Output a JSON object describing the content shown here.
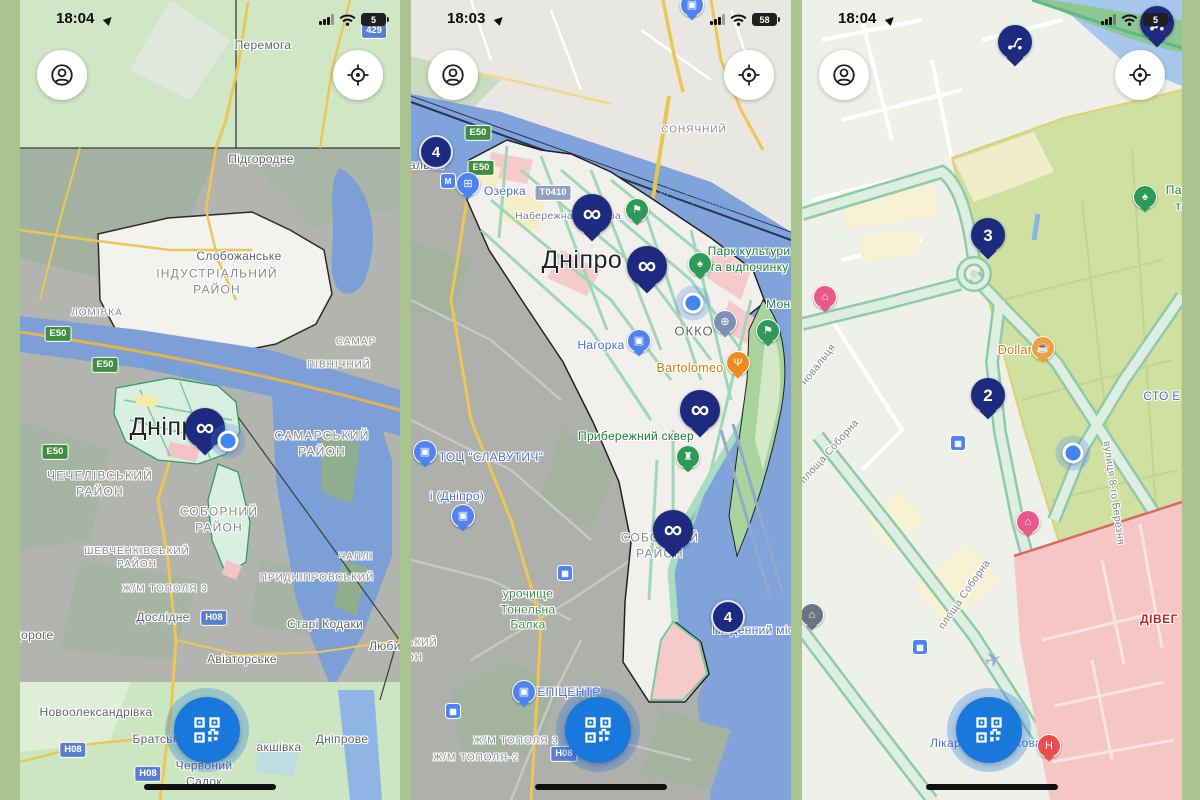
{
  "app": {
    "background_color": "#a9c48f",
    "colors": {
      "marker_navy": "#1c2b80",
      "qr_button_blue": "#1878dc",
      "location_dot_blue": "#4285f4",
      "road_badge_green": "#3f8f3f",
      "road_badge_blue": "#5b7fd0",
      "poi_blue": "#4f84f0",
      "poi_green": "#2d9b57"
    }
  },
  "phones": [
    {
      "status": {
        "time": "18:04",
        "battery": "5"
      },
      "labels": [
        {
          "t": "Перемога",
          "c": "town",
          "x": 243,
          "y": 46
        },
        {
          "t": "Підгородне",
          "c": "town",
          "x": 241,
          "y": 160
        },
        {
          "t": "Слобожанське",
          "c": "town",
          "x": 219,
          "y": 257
        },
        {
          "t": "ІНДУСТРІАЛЬНИЙ\nРАЙОН",
          "c": "district",
          "x": 197,
          "y": 282
        },
        {
          "t": "ЛОМІВКА",
          "c": "district-sm",
          "x": 77,
          "y": 313
        },
        {
          "t": "САМАР",
          "c": "district-sm",
          "x": 336,
          "y": 342
        },
        {
          "t": "ПІВНІЧНИЙ",
          "c": "district-sm",
          "x": 319,
          "y": 365
        },
        {
          "t": "Е50",
          "c": "badge-green",
          "x": 38,
          "y": 334
        },
        {
          "t": "Е50",
          "c": "badge-green",
          "x": 85,
          "y": 365
        },
        {
          "t": "Е50",
          "c": "badge-green",
          "x": 35,
          "y": 452
        },
        {
          "t": "річка Дніпро",
          "c": "water-label",
          "x": 163,
          "y": 373,
          "r": 16
        },
        {
          "t": "Дніпро",
          "c": "city",
          "x": 150,
          "y": 427
        },
        {
          "t": "САМАРСЬКИЙ\nРАЙОН",
          "c": "district",
          "x": 302,
          "y": 444
        },
        {
          "t": "ЧЕЧЕЛІВСЬКИЙ\nРАЙОН",
          "c": "district",
          "x": 80,
          "y": 484
        },
        {
          "t": "СОБОРНИЙ\nРАЙОН",
          "c": "district",
          "x": 199,
          "y": 520
        },
        {
          "t": "ШЕВЧЕНКІВСЬКИЙ\nРАЙОН",
          "c": "district-sm",
          "x": 117,
          "y": 558
        },
        {
          "t": "ЧАПЛІ",
          "c": "district-sm",
          "x": 336,
          "y": 557
        },
        {
          "t": "ПРИДНІПРОВСЬКИЙ",
          "c": "district-sm",
          "x": 297,
          "y": 578
        },
        {
          "t": "Ж/М ТОПОЛЯ 3",
          "c": "district-sm",
          "x": 145,
          "y": 589
        },
        {
          "t": "Дослідне",
          "c": "town",
          "x": 143,
          "y": 618
        },
        {
          "t": "Н08",
          "c": "badge-blue",
          "x": 194,
          "y": 618
        },
        {
          "t": "Старі Кодаки",
          "c": "town",
          "x": 305,
          "y": 625
        },
        {
          "t": "Дороге",
          "c": "town",
          "x": 13,
          "y": 636
        },
        {
          "t": "Авіаторське",
          "c": "town",
          "x": 222,
          "y": 660
        },
        {
          "t": "Любимів",
          "c": "town",
          "x": 374,
          "y": 647
        },
        {
          "t": "Новоолександрівка",
          "c": "town",
          "x": 76,
          "y": 713
        },
        {
          "t": "Н08",
          "c": "badge-blue",
          "x": 53,
          "y": 750
        },
        {
          "t": "Братське",
          "c": "town",
          "x": 139,
          "y": 740
        },
        {
          "t": "акшівка",
          "c": "town",
          "x": 259,
          "y": 748
        },
        {
          "t": "Дніпрове",
          "c": "town",
          "x": 322,
          "y": 740
        },
        {
          "t": "Червоний\nСадок",
          "c": "town",
          "x": 184,
          "y": 774
        },
        {
          "t": "Н08",
          "c": "badge-blue",
          "x": 128,
          "y": 774
        },
        {
          "t": "429",
          "c": "badge-blue",
          "x": 354,
          "y": 31
        }
      ],
      "pins": [
        {
          "k": "inf",
          "name": "infinity-scooter-marker",
          "x": 185,
          "y": 428
        },
        {
          "k": "dot",
          "name": "current-location-dot",
          "x": 208,
          "y": 441
        }
      ]
    },
    {
      "status": {
        "time": "18:03",
        "battery": "58"
      },
      "labels": [
        {
          "t": "СОНЯЧНИЙ",
          "c": "district-sm",
          "x": 283,
          "y": 130
        },
        {
          "t": "Е50",
          "c": "badge-green",
          "x": 67,
          "y": 133
        },
        {
          "t": "Е50",
          "c": "badge-green",
          "x": 70,
          "y": 168
        },
        {
          "t": "Вокзальна",
          "c": "town",
          "x": 2,
          "y": 166
        },
        {
          "t": "Озерка",
          "c": "poi-blue-label",
          "x": 94,
          "y": 192
        },
        {
          "t": "Т0410",
          "c": "badge-grey",
          "x": 142,
          "y": 193
        },
        {
          "t": "Набережна",
          "c": "street",
          "x": 133,
          "y": 217
        },
        {
          "t": "ра",
          "c": "street",
          "x": 204,
          "y": 217
        },
        {
          "t": "річка Дніпро",
          "c": "water-label",
          "x": 285,
          "y": 200,
          "r": 14
        },
        {
          "t": "Дніпро",
          "c": "city",
          "x": 171,
          "y": 260
        },
        {
          "t": "Парк культури",
          "c": "poi-green-label",
          "x": 338,
          "y": 252
        },
        {
          "t": "та відпочинку",
          "c": "poi-green-label",
          "x": 338,
          "y": 268
        },
        {
          "t": "Монастирський",
          "c": "poi-green-label",
          "x": 400,
          "y": 305
        },
        {
          "t": "ОККО",
          "c": "poi-grey-label",
          "x": 283,
          "y": 332
        },
        {
          "t": "Нагорка",
          "c": "poi-blue-label",
          "x": 190,
          "y": 346
        },
        {
          "t": "Bartolomeo",
          "c": "poi-orange-label",
          "x": 279,
          "y": 368
        },
        {
          "t": "Прибережний сквер",
          "c": "poi-green-label",
          "x": 225,
          "y": 437
        },
        {
          "t": "ТОЦ \"СЛАВУТИЧ\"",
          "c": "poi-blue-label",
          "x": 80,
          "y": 458
        },
        {
          "t": "і (Дніпро)",
          "c": "poi-blue-label",
          "x": 46,
          "y": 497
        },
        {
          "t": "СОБОРНИЙ\nРАЙОН",
          "c": "district",
          "x": 249,
          "y": 546
        },
        {
          "t": "урочище\nТонельна\nБалка",
          "c": "nature-label",
          "x": 117,
          "y": 610
        },
        {
          "t": "Південний міст",
          "c": "poi-blue-label",
          "x": 345,
          "y": 631
        },
        {
          "t": "ШЕВЧЕНКІВСЬКИЙ",
          "c": "district-sm",
          "x": -26,
          "y": 643
        },
        {
          "t": "РАЙОН",
          "c": "district-sm",
          "x": -8,
          "y": 658
        },
        {
          "t": "ЕПІЦЕНТР",
          "c": "poi-blue-label",
          "x": 158,
          "y": 693
        },
        {
          "t": "Н08",
          "c": "badge-blue",
          "x": 153,
          "y": 754
        },
        {
          "t": "Ж/М ТОПОЛЯ 3",
          "c": "district-sm",
          "x": 105,
          "y": 741
        },
        {
          "t": "Ж/М ТОПОЛЯ-2",
          "c": "district-sm",
          "x": 65,
          "y": 758
        }
      ],
      "pins": [
        {
          "k": "poi",
          "name": "shop-poi-pin",
          "glyph": "briefcase",
          "color": "#4f84f0",
          "x": 281,
          "y": 5
        },
        {
          "k": "cluster",
          "name": "scooter-count-badge",
          "n": "4",
          "x": 25,
          "y": 152
        },
        {
          "k": "transit",
          "name": "metro-station-icon",
          "glyph": "metro",
          "x": 37,
          "y": 181
        },
        {
          "k": "poi",
          "name": "shopping-poi-pin",
          "glyph": "cart",
          "color": "#4f84f0",
          "x": 57,
          "y": 184
        },
        {
          "k": "inf",
          "name": "infinity-scooter-marker",
          "x": 181,
          "y": 214
        },
        {
          "k": "poi",
          "name": "trail-poi-pin",
          "glyph": "hiker",
          "color": "#2d9b57",
          "x": 226,
          "y": 210
        },
        {
          "k": "inf",
          "name": "infinity-scooter-marker",
          "x": 236,
          "y": 266
        },
        {
          "k": "poi",
          "name": "park-poi-pin",
          "glyph": "tree",
          "color": "#2d9b57",
          "x": 289,
          "y": 264
        },
        {
          "k": "dot",
          "name": "current-location-dot",
          "x": 282,
          "y": 303
        },
        {
          "k": "poi",
          "name": "fuel-station-poi-pin",
          "glyph": "fuel",
          "color": "#7e90b8",
          "x": 314,
          "y": 322
        },
        {
          "k": "poi",
          "name": "shopping-poi-pin",
          "glyph": "bag",
          "color": "#4f84f0",
          "x": 228,
          "y": 341
        },
        {
          "k": "poi",
          "name": "restaurant-poi-pin",
          "glyph": "restaurant",
          "color": "#ef8a1f",
          "x": 327,
          "y": 363
        },
        {
          "k": "poi",
          "name": "trail-poi-pin",
          "glyph": "hiker",
          "color": "#2d9b57",
          "x": 357,
          "y": 331
        },
        {
          "k": "inf",
          "name": "infinity-scooter-marker",
          "x": 289,
          "y": 410
        },
        {
          "k": "poi",
          "name": "monument-poi-pin",
          "glyph": "monument",
          "color": "#2d9b57",
          "x": 277,
          "y": 457
        },
        {
          "k": "poi",
          "name": "shopping-poi-pin",
          "glyph": "bag",
          "color": "#4f84f0",
          "x": 14,
          "y": 452
        },
        {
          "k": "poi",
          "name": "shopping-poi-pin",
          "glyph": "bag",
          "color": "#4f84f0",
          "x": 52,
          "y": 516
        },
        {
          "k": "inf",
          "name": "infinity-scooter-marker",
          "x": 262,
          "y": 530
        },
        {
          "k": "transit",
          "name": "train-station-icon",
          "glyph": "train",
          "x": 154,
          "y": 573
        },
        {
          "k": "cluster",
          "name": "scooter-count-badge",
          "n": "4",
          "x": 317,
          "y": 617
        },
        {
          "k": "poi",
          "name": "shopping-poi-pin",
          "glyph": "bag",
          "color": "#4f84f0",
          "x": 113,
          "y": 692
        },
        {
          "k": "transit",
          "name": "bus-station-icon",
          "glyph": "bus",
          "x": 42,
          "y": 711
        }
      ]
    },
    {
      "status": {
        "time": "18:04",
        "battery": "5"
      },
      "labels": [
        {
          "t": "Парк",
          "c": "poi-green-label",
          "x": 378,
          "y": 191
        },
        {
          "t": "та відпочинку",
          "c": "poi-green-label",
          "x": 413,
          "y": 207
        },
        {
          "t": "Dollar",
          "c": "poi-orange-label",
          "x": 213,
          "y": 350
        },
        {
          "t": "СТО Е",
          "c": "poi-blue-label",
          "x": 360,
          "y": 397
        },
        {
          "t": "новальця",
          "c": "street",
          "x": 17,
          "y": 365,
          "r": -52
        },
        {
          "t": "площа Соборна",
          "c": "street",
          "x": 28,
          "y": 452,
          "r": -48
        },
        {
          "t": "вулиця 8-го Березня",
          "c": "street",
          "x": 311,
          "y": 493,
          "r": 82
        },
        {
          "t": "площа Соборна",
          "c": "street",
          "x": 163,
          "y": 595,
          "r": -55
        },
        {
          "t": "ДІВЕГ",
          "c": "poi-red-label",
          "x": 357,
          "y": 620
        },
        {
          "t": "Лікарня Мечникова",
          "c": "poi-blue-label",
          "x": 184,
          "y": 744
        }
      ],
      "pins": [
        {
          "k": "scooter",
          "name": "scooter-pin",
          "x": 213,
          "y": 42
        },
        {
          "k": "scooter",
          "name": "scooter-pin",
          "x": 355,
          "y": 23
        },
        {
          "k": "poi",
          "name": "park-poi-pin",
          "glyph": "tree",
          "color": "#2d9b57",
          "x": 343,
          "y": 197
        },
        {
          "k": "num",
          "name": "scooter-count-marker",
          "n": "3",
          "x": 186,
          "y": 235
        },
        {
          "k": "poi",
          "name": "hotel-poi-pin",
          "glyph": "hotel",
          "color": "#e9588a",
          "x": 23,
          "y": 297
        },
        {
          "k": "poi",
          "name": "cafe-poi-pin",
          "glyph": "coffee",
          "color": "#f0a13c",
          "x": 241,
          "y": 348
        },
        {
          "k": "num",
          "name": "scooter-count-marker",
          "n": "2",
          "x": 186,
          "y": 395
        },
        {
          "k": "transit",
          "name": "tram-station-icon",
          "glyph": "tram",
          "x": 156,
          "y": 443
        },
        {
          "k": "dot",
          "name": "current-location-dot",
          "x": 271,
          "y": 453
        },
        {
          "k": "poi",
          "name": "hotel-poi-pin",
          "glyph": "hotel",
          "color": "#e9588a",
          "x": 226,
          "y": 522
        },
        {
          "k": "poi",
          "name": "museum-poi-pin",
          "glyph": "museum",
          "color": "#6b7280",
          "x": 10,
          "y": 615
        },
        {
          "k": "transit",
          "name": "tram-station-icon",
          "glyph": "tram",
          "x": 118,
          "y": 647
        },
        {
          "k": "plane",
          "name": "airfield-symbol",
          "x": 191,
          "y": 660
        },
        {
          "k": "poi",
          "name": "hospital-poi-pin",
          "glyph": "hospital",
          "color": "#ec4c4c",
          "x": 247,
          "y": 746
        }
      ]
    }
  ]
}
